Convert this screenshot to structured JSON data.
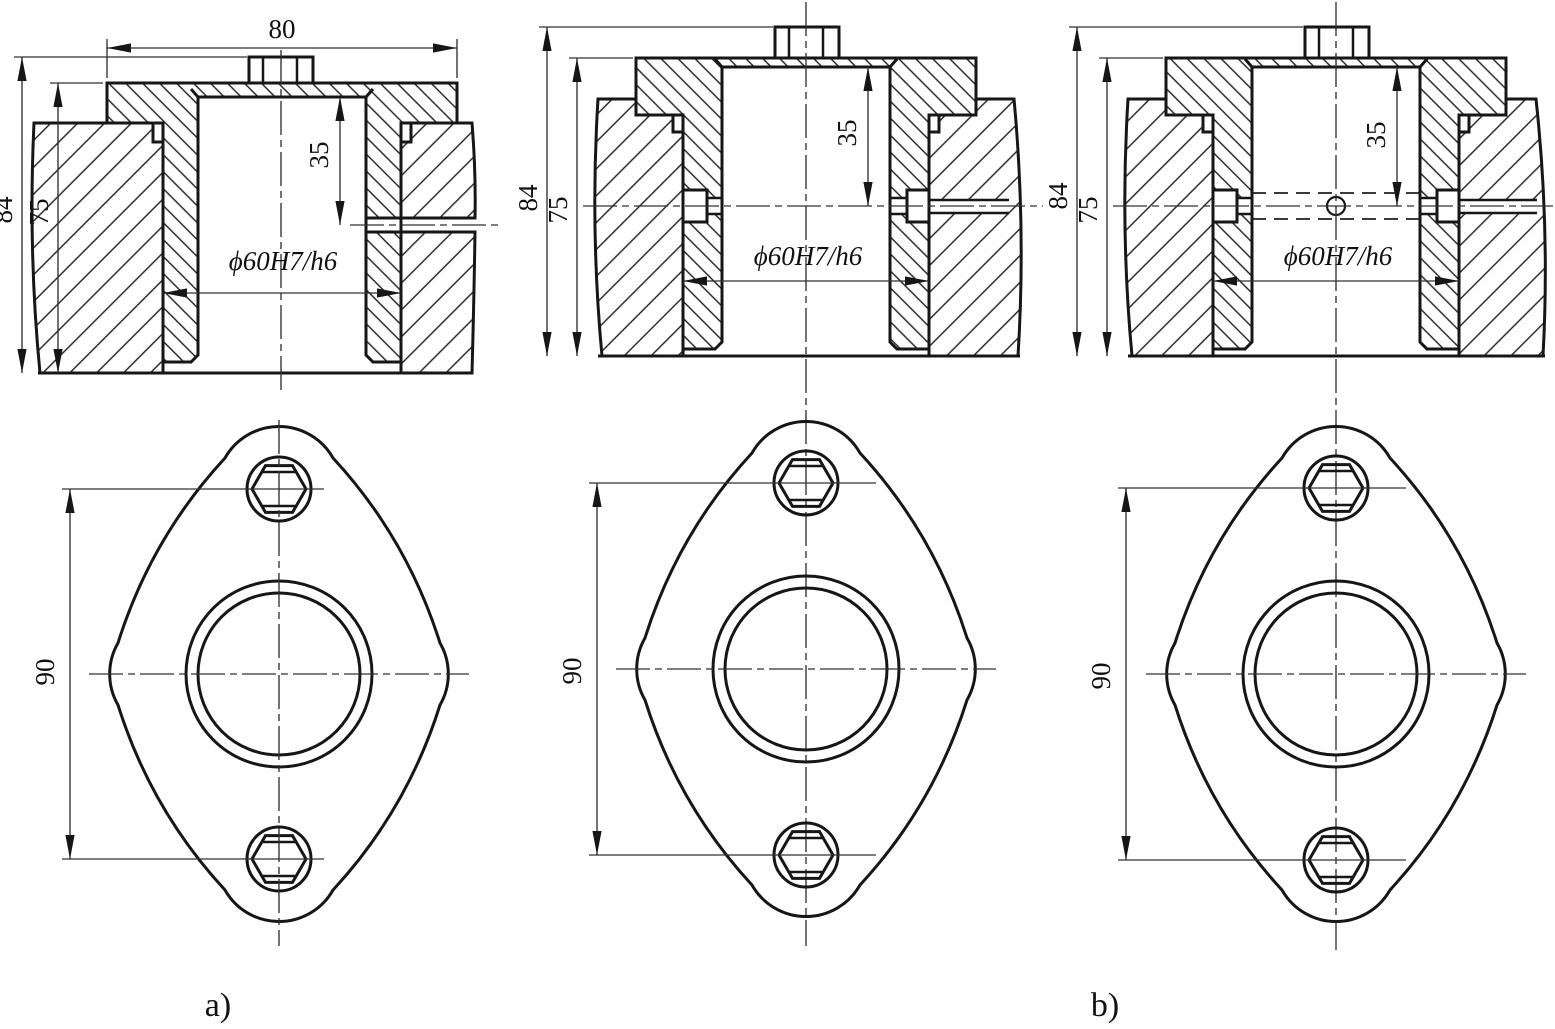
{
  "page": {
    "background": "#ffffff",
    "ink": "#161616"
  },
  "views": {
    "a": {
      "caption": "a)",
      "dims": {
        "width": "80",
        "height_total": "84",
        "height_plate": "75",
        "hole_depth": "35",
        "fit": "ϕ60H7/h6",
        "bolt_spacing": "90"
      }
    },
    "middle": {
      "dims": {
        "height_total": "84",
        "height_plate": "75",
        "hole_depth": "35",
        "fit": "ϕ60H7/h6",
        "bolt_spacing": "90"
      }
    },
    "b": {
      "caption": "b)",
      "dims": {
        "height_total": "84",
        "height_plate": "75",
        "hole_depth": "35",
        "fit": "ϕ60H7/h6",
        "bolt_spacing": "90"
      }
    }
  }
}
